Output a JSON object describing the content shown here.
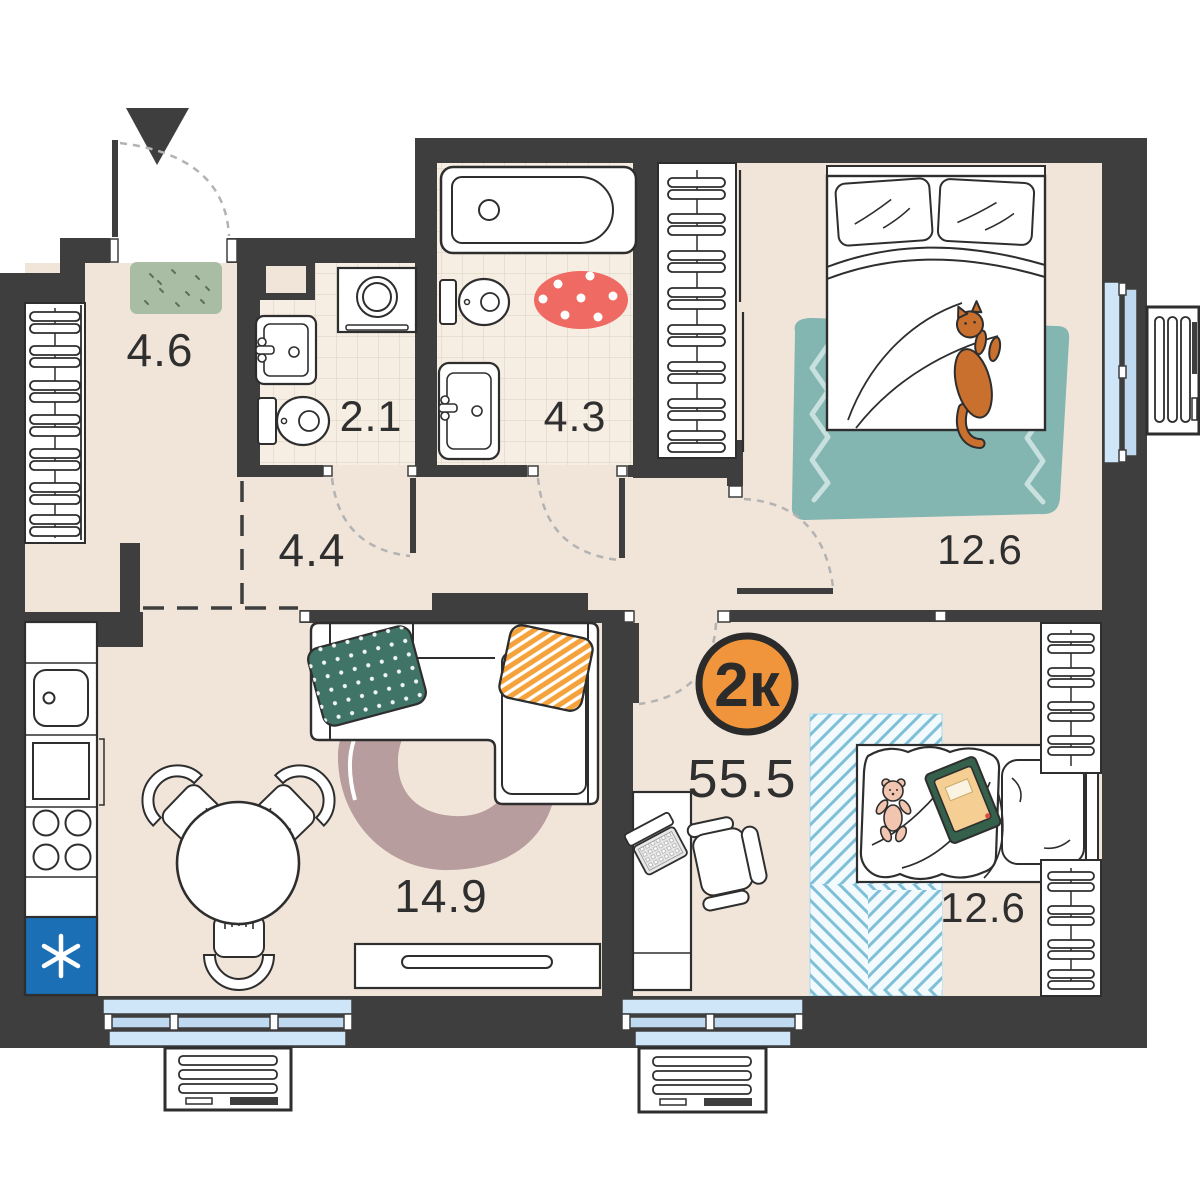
{
  "plan": {
    "badge": {
      "label": "2к"
    },
    "total_area": "55.5",
    "rooms": [
      {
        "name": "hallway",
        "area": "4.6"
      },
      {
        "name": "toilet",
        "area": "2.1"
      },
      {
        "name": "bathroom",
        "area": "4.3"
      },
      {
        "name": "corridor",
        "area": "4.4"
      },
      {
        "name": "bedroom-top",
        "area": "12.6"
      },
      {
        "name": "living-kitchen",
        "area": "14.9"
      },
      {
        "name": "bedroom-bottom",
        "area": "12.6"
      }
    ],
    "colors": {
      "wall": "#3E3E3E",
      "floor": "#F1E5DA",
      "tile": "#F6EDE3",
      "window": "#BFD9F0",
      "window_light": "#CFE6F8",
      "fridge": "#1B6FB5",
      "badge": "#F0953B",
      "rug_teal": "#83B5B1",
      "rug_red": "#EE6A62",
      "rug_mauve": "#B79D9D",
      "rug_blue_stripe": "#7FC0D8",
      "pillow_green": "#3F7467",
      "pillow_orange": "#F5A23C",
      "doormat": "#A9BCA4",
      "cat": "#C9702F"
    }
  }
}
